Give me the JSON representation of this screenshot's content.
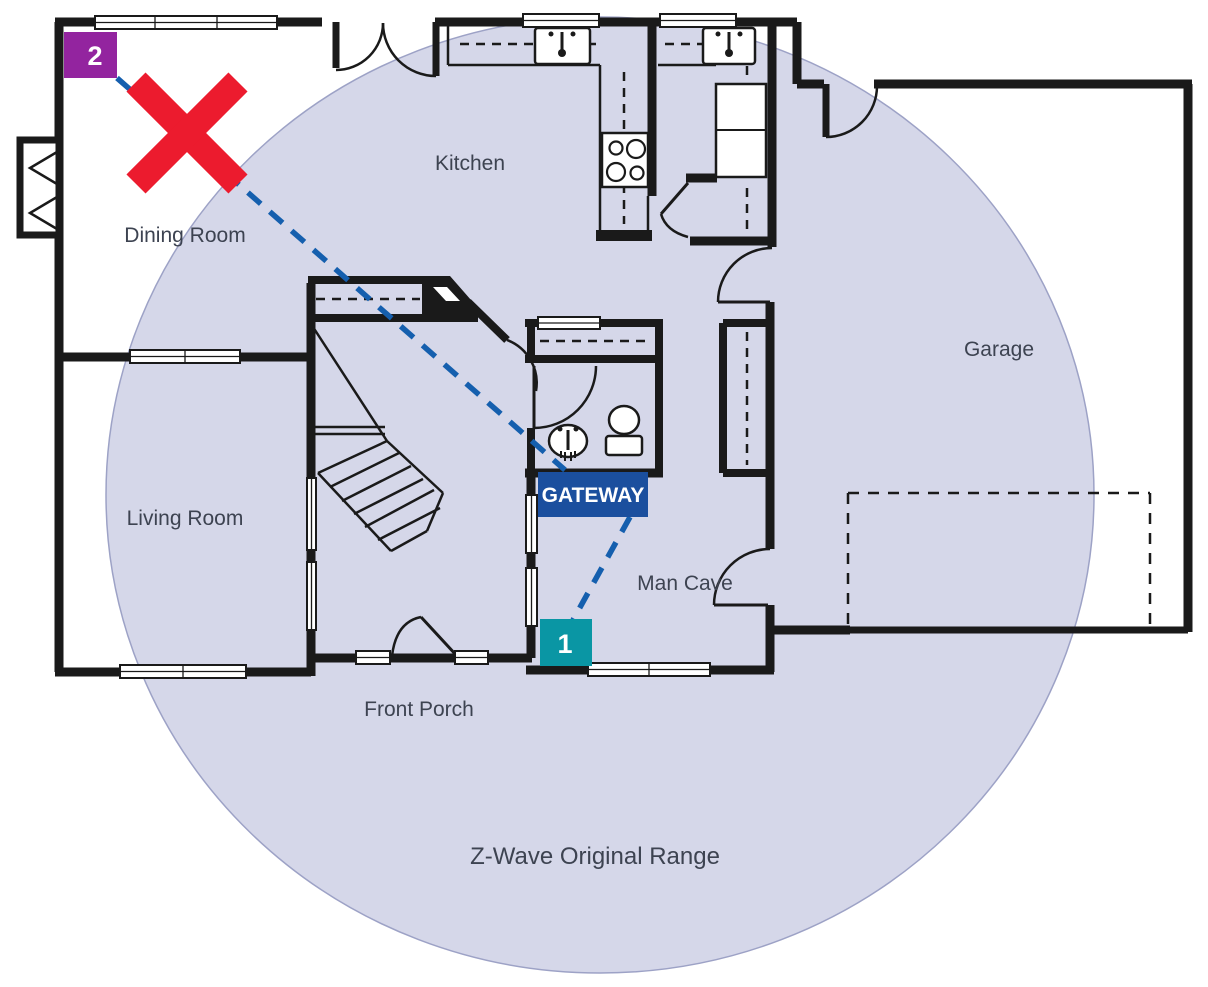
{
  "diagram_title": "Z-Wave Original Range floor plan",
  "rooms": {
    "kitchen": "Kitchen",
    "dining": "Dining Room",
    "living": "Living Room",
    "garage": "Garage",
    "man_cave": "Man Cave",
    "front_porch": "Front Porch"
  },
  "range_label": "Z-Wave Original Range",
  "gateway": {
    "label": "GATEWAY"
  },
  "nodes": [
    {
      "id": "1",
      "status": "in-range"
    },
    {
      "id": "2",
      "status": "out-of-range"
    }
  ],
  "icons": {
    "out_of_range": "red-x-icon",
    "signal_path": "dashed-line",
    "range_area": "ellipse"
  },
  "colors": {
    "range": "#d5d7e9",
    "rangeEdge": "#9da2c6",
    "wall": "#1a1a1a",
    "signal": "#155fae",
    "alert": "#ec1b2e",
    "gateway": "#1b4f9e",
    "node1": "#0a96a4",
    "node2": "#93249f",
    "label": "#3d4351"
  }
}
